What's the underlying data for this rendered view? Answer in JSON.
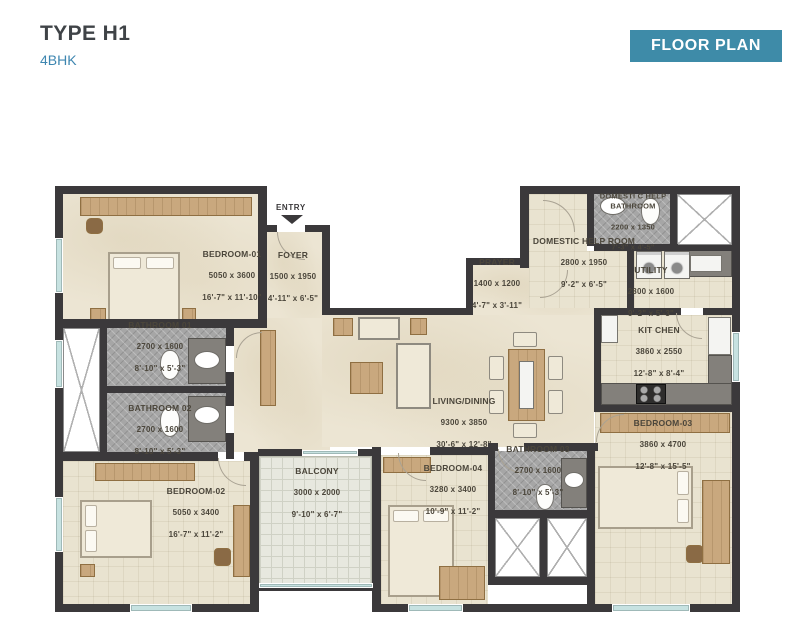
{
  "header": {
    "title": "TYPE H1",
    "subtitle": "4BHK",
    "badge": "FLOOR PLAN"
  },
  "plan": {
    "entry": "ENTRY",
    "rooms": {
      "bedroom01": {
        "name": "BEDROOM-01",
        "mm": "5050 x 3600",
        "ft": "16'-7\" x 11'-10\""
      },
      "foyer": {
        "name": "FOYER",
        "mm": "1500 x 1950",
        "ft": "4'-11\" x 6'-5\""
      },
      "bathroom01": {
        "name": "BATHROOM 01",
        "mm": "2700 x 1600",
        "ft": "8'-10\" x 5'-3\""
      },
      "bathroom02": {
        "name": "BATHROOM 02",
        "mm": "2700 x 1600",
        "ft": "8'-10\" x 5'-3\""
      },
      "prayer": {
        "name": "PRAYER",
        "mm": "1400 x 1200",
        "ft": "4'-7\" x 3'-11\""
      },
      "dh_bathroom": {
        "name": "DOMESTI C HELP\nBATHROOM",
        "mm": "2200 x 1350",
        "ft": "7'-3\" x 4'-5\""
      },
      "dh_room": {
        "name": "DOMESTIC HELP ROOM",
        "mm": "2800 x 1950",
        "ft": "9'-2\" x 6'-5\""
      },
      "utility": {
        "name": "UTILITY",
        "mm": "2800 x 1600",
        "ft": "9'-2\" x 5'-3\""
      },
      "kitchen": {
        "name": "KIT CHEN",
        "mm": "3860 x 2550",
        "ft": "12'-8\" x 8'-4\""
      },
      "living": {
        "name": "LIVING/DINING",
        "mm": "9300 x 3850",
        "ft": "30'-6\" x 12'-8\""
      },
      "bedroom02": {
        "name": "BEDROOM-02",
        "mm": "5050 x 3400",
        "ft": "16'-7\" x 11'-2\""
      },
      "balcony": {
        "name": "BALCONY",
        "mm": "3000 x 2000",
        "ft": "9'-10\" x 6'-7\""
      },
      "bedroom04": {
        "name": "BEDROOM-04",
        "mm": "3280 x 3400",
        "ft": "10'-9\" x 11'-2\""
      },
      "bathroom03": {
        "name": "BATHROOM 03",
        "mm": "2700 x 1600",
        "ft": "8'-10\" x 5'-3\""
      },
      "bedroom03": {
        "name": "BEDROOM-03",
        "mm": "3860 x 4700",
        "ft": "12'-8\" x 15'-5\""
      }
    }
  },
  "colors": {
    "badge_teal": "#3e8ba8",
    "subtitle_blue": "#3e86b0",
    "wall": "#3b393b",
    "floor_beige": "#e9e3d0",
    "bath_tile_gray": "#a6a6a6",
    "balcony_tile": "#e7e8df",
    "wood": "#c9a87e",
    "window_teal": "#c7e2e1",
    "label_text": "#4b463b"
  }
}
